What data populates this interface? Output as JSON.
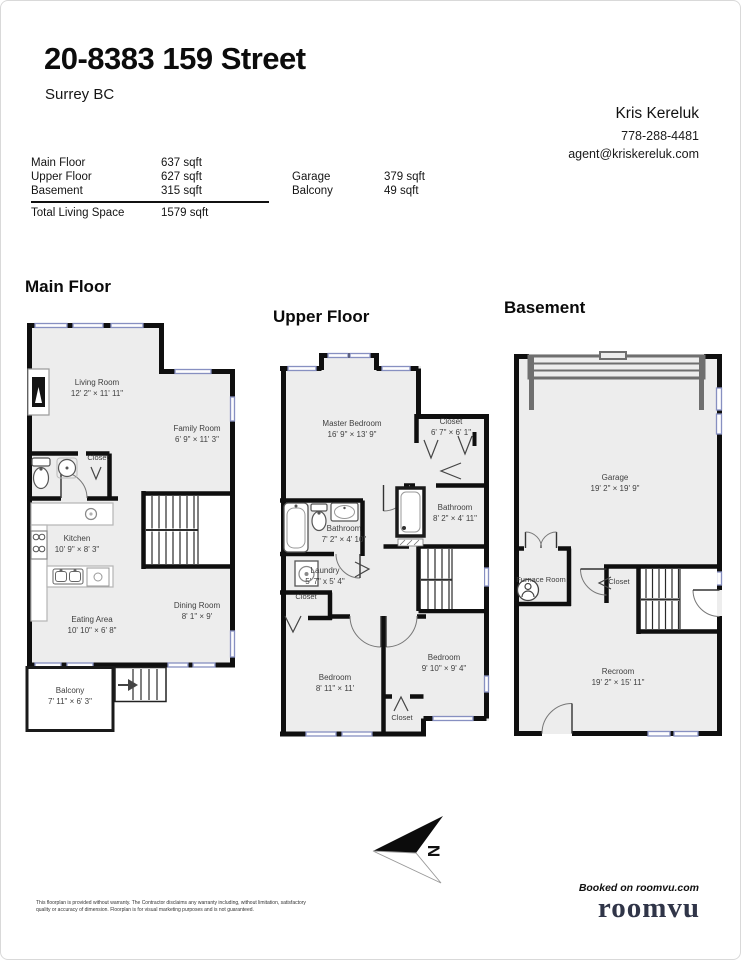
{
  "header": {
    "title": "20-8383 159 Street",
    "subtitle": "Surrey BC",
    "agent": {
      "name": "Kris Kereluk",
      "phone": "778-288-4481",
      "email": "agent@kriskereluk.com"
    }
  },
  "areas": {
    "rows": [
      {
        "label": "Main Floor",
        "value": "637 sqft"
      },
      {
        "label": "Upper Floor",
        "value": "627 sqft"
      },
      {
        "label": "Basement",
        "value": "315 sqft"
      }
    ],
    "total": {
      "label": "Total Living Space",
      "value": "1579 sqft"
    },
    "extra": [
      {
        "label": "Garage",
        "value": "379 sqft"
      },
      {
        "label": "Balcony",
        "value": "49 sqft"
      }
    ]
  },
  "plans": {
    "main": {
      "heading": "Main Floor",
      "rooms": [
        {
          "name": "Living Room",
          "dims": "12' 2\" × 11' 11\""
        },
        {
          "name": "Family Room",
          "dims": "6' 9\" × 11' 3\""
        },
        {
          "name": "Closet",
          "dims": ""
        },
        {
          "name": "Kitchen",
          "dims": "10' 9\" × 8' 3\""
        },
        {
          "name": "Eating Area",
          "dims": "10' 10\" × 6' 8\""
        },
        {
          "name": "Dining Room",
          "dims": "8' 1\" × 9'"
        },
        {
          "name": "Balcony",
          "dims": "7' 11\" × 6' 3\""
        }
      ]
    },
    "upper": {
      "heading": "Upper Floor",
      "rooms": [
        {
          "name": "Master Bedroom",
          "dims": "16' 9\" × 13' 9\""
        },
        {
          "name": "Closet",
          "dims": "6' 7\" × 6' 1\""
        },
        {
          "name": "Bathroom",
          "dims": "7' 2\" × 4' 10\""
        },
        {
          "name": "Laundry",
          "dims": "5' 7\" x 5' 4\""
        },
        {
          "name": "Closet",
          "dims": ""
        },
        {
          "name": "Bedroom",
          "dims": "8' 11\" × 11'"
        },
        {
          "name": "Bedroom",
          "dims": "9' 10\" × 9' 4\""
        },
        {
          "name": "Closet",
          "dims": ""
        },
        {
          "name": "Bathroom",
          "dims": "8' 2\" × 4' 11\""
        }
      ]
    },
    "basement": {
      "heading": "Basement",
      "rooms": [
        {
          "name": "Garage",
          "dims": "19' 2\" × 19' 9\""
        },
        {
          "name": "Furnace Room",
          "dims": ""
        },
        {
          "name": "Closet",
          "dims": ""
        },
        {
          "name": "Recroom",
          "dims": "19' 2\" × 15' 11\""
        }
      ]
    }
  },
  "compass": {
    "letter": "N"
  },
  "footer": {
    "disclaimer_line1": "This floorplan is provided without warranty. The Contractor disclaims any warranty including, without limitation, satisfactory",
    "disclaimer_line2": "quality or accuracy of dimension. Floorplan is for visual marketing purposes and is not guaranteed.",
    "booked": "Booked on roomvu.com",
    "logo": "roomvu"
  },
  "colors": {
    "wall": "#0f0f0f",
    "room_fill": "#ededed",
    "window": "#8790c1",
    "logo": "#303548"
  }
}
